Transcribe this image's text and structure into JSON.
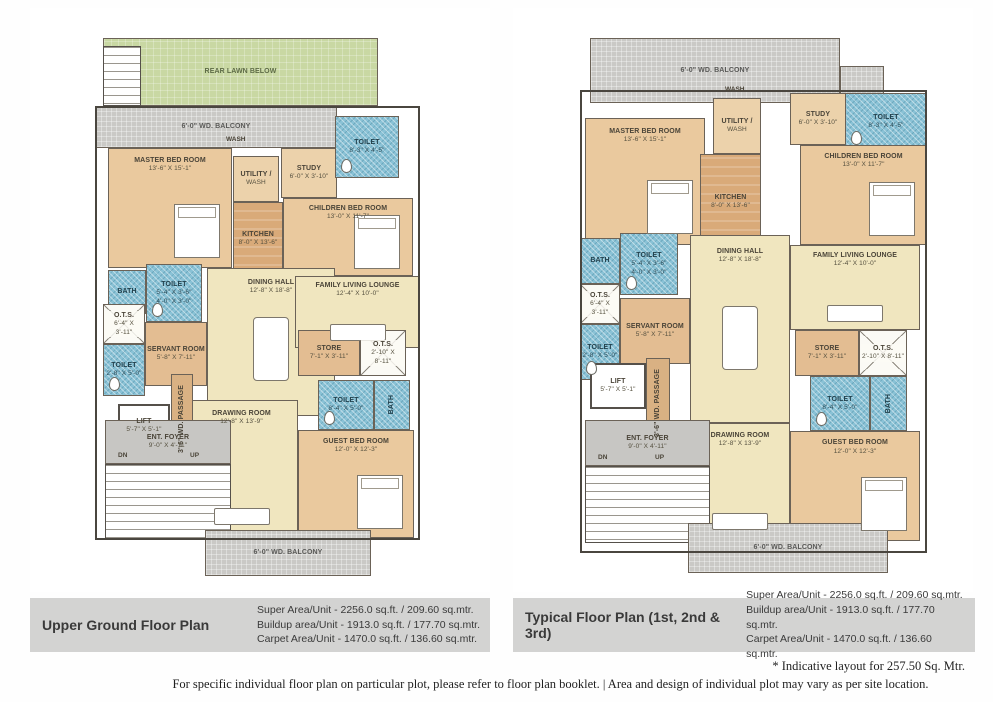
{
  "palette": {
    "lawn": "#c9d8a3",
    "balcony": "#cac9c6",
    "bedroom": "#eac99e",
    "kitchen": "#d9aa79",
    "living": "#f0e6bf",
    "toilet_mosaic": "#8ac2d6",
    "servant": "#e3bd92",
    "foyer": "#c7c6c3",
    "caption_bar": "#d3d3d2",
    "wall": "#4a463f"
  },
  "footer": {
    "note": "* Indicative layout for 257.50 Sq. Mtr.",
    "disclaimer": "For specific individual floor plan on particular plot, please refer to floor plan booklet.  |  Area and design of individual plot may vary as per site location."
  },
  "plans": [
    {
      "title": "Upper Ground Floor Plan",
      "areas": [
        "Super Area/Unit - 2256.0 sq.ft. / 209.60 sq.mtr.",
        "Buildup area/Unit - 1913.0 sq.ft. / 177.70 sq.mtr.",
        "Carpet Area/Unit - 1470.0 sq.ft. / 136.60 sq.mtr."
      ],
      "rooms": [
        {
          "name": "REAR LAWN BELOW",
          "type": "lawn",
          "rect": [
            73,
            30,
            275,
            68
          ]
        },
        {
          "name": "",
          "type": "stair",
          "rect": [
            73,
            38,
            38,
            60
          ]
        },
        {
          "name": "6'-0\" WD. BALCONY",
          "type": "balcony",
          "rect": [
            65,
            98,
            242,
            42
          ]
        },
        {
          "name": "MASTER BED ROOM",
          "dims": "13'-6\" X 15'-1\"",
          "type": "bedroom",
          "rect": [
            78,
            140,
            124,
            120
          ],
          "furniture": "bed"
        },
        {
          "name": "UTILITY /",
          "dims": "WASH",
          "type": "utility",
          "rect": [
            203,
            148,
            46,
            46
          ]
        },
        {
          "name": "KITCHEN",
          "dims": "8'-0\" X 13'-6\"",
          "type": "kitchen",
          "rect": [
            203,
            194,
            50,
            74
          ]
        },
        {
          "name": "STUDY",
          "dims": "6'-0\" X 3'-10\"",
          "type": "utility",
          "rect": [
            251,
            140,
            56,
            50
          ]
        },
        {
          "name": "CHILDREN BED ROOM",
          "dims": "13'-0\" X 11'-7\"",
          "type": "bedroom",
          "rect": [
            253,
            190,
            130,
            78
          ],
          "furniture": "bed"
        },
        {
          "name": "DINING HALL",
          "dims": "12'-8\" X 18'-8\"",
          "type": "living",
          "rect": [
            177,
            260,
            128,
            148
          ],
          "furniture": "table"
        },
        {
          "name": "FAMILY LIVING LOUNGE",
          "dims": "12'-4\" X 10'-0\"",
          "type": "living",
          "rect": [
            265,
            268,
            125,
            72
          ],
          "furniture": "sofa"
        },
        {
          "name": "DRAWING ROOM",
          "dims": "12'-8\" X 13'-9\"",
          "type": "living",
          "rect": [
            155,
            392,
            113,
            138
          ],
          "furniture": "sofa"
        },
        {
          "name": "GUEST BED ROOM",
          "dims": "12'-0\" X 12'-3\"",
          "type": "bedroom",
          "rect": [
            268,
            422,
            116,
            108
          ],
          "furniture": "bed"
        },
        {
          "name": "TOILET",
          "dims": "8'-3\" X 4'-5\"",
          "type": "toilet",
          "rect": [
            305,
            108,
            64,
            62
          ]
        },
        {
          "name": "BATH",
          "type": "toilet",
          "rect": [
            78,
            262,
            38,
            44
          ]
        },
        {
          "name": "TOILET",
          "dims": "5'-4\" X 3'-6\"",
          "dims2": "4'-0\" X 3'-0\"",
          "type": "toilet",
          "rect": [
            116,
            256,
            56,
            58
          ]
        },
        {
          "name": "O.T.S.",
          "dims": "6'-4\" X 3'-11\"",
          "type": "ots",
          "rect": [
            73,
            296,
            42,
            40
          ]
        },
        {
          "name": "TOILET",
          "dims": "2'-8\" X 5'-0\"",
          "type": "toilet",
          "rect": [
            73,
            336,
            42,
            52
          ]
        },
        {
          "name": "SERVANT ROOM",
          "dims": "5'-8\" X 7'-11\"",
          "type": "servant",
          "rect": [
            115,
            314,
            62,
            64
          ]
        },
        {
          "name": "STORE",
          "dims": "7'-1\" X 3'-11\"",
          "type": "servant",
          "rect": [
            268,
            322,
            62,
            46
          ]
        },
        {
          "name": "O.T.S.",
          "dims": "2'-10\" X 8'-11\"",
          "type": "ots",
          "rect": [
            330,
            322,
            46,
            46
          ]
        },
        {
          "name": "TOILET",
          "dims": "8'-4\" X 5'-0\"",
          "type": "toilet",
          "rect": [
            288,
            372,
            56,
            50
          ]
        },
        {
          "name": "BATH",
          "type": "toilet",
          "rect": [
            344,
            372,
            36,
            50
          ],
          "vertical": true
        },
        {
          "name": "LIFT",
          "dims": "5'-7\" X 5'-1\"",
          "type": "lift",
          "rect": [
            88,
            396,
            52,
            44
          ]
        },
        {
          "name": "3'-6\" WD. PASSAGE",
          "type": "passage",
          "rect": [
            141,
            366,
            22,
            90
          ],
          "vertical": true
        },
        {
          "name": "ENT. FOYER",
          "dims": "9'-0\" X 4'-11\"",
          "type": "foyer",
          "rect": [
            75,
            412,
            126,
            44
          ]
        },
        {
          "name": "",
          "type": "stair",
          "rect": [
            75,
            456,
            126,
            76
          ]
        },
        {
          "name": "6'-0\" WD. BALCONY",
          "type": "balcony",
          "rect": [
            175,
            522,
            166,
            46
          ]
        },
        {
          "name": "",
          "type": "outline",
          "rect": [
            65,
            98,
            325,
            434
          ]
        }
      ],
      "labels": [
        {
          "text": "WASH",
          "x": 196,
          "y": 128
        },
        {
          "text": "DN",
          "x": 88,
          "y": 444
        },
        {
          "text": "UP",
          "x": 160,
          "y": 444
        }
      ]
    },
    {
      "title": "Typical Floor Plan (1st, 2nd & 3rd)",
      "areas": [
        "Super Area/Unit - 2256.0 sq.ft. / 209.60 sq.mtr.",
        "Buildup area/Unit - 1913.0 sq.ft. / 177.70 sq.mtr.",
        "Carpet Area/Unit - 1470.0 sq.ft. / 136.60 sq.mtr."
      ],
      "rooms": [
        {
          "name": "6'-0\" WD. BALCONY",
          "type": "balcony",
          "rect": [
            77,
            30,
            250,
            65
          ]
        },
        {
          "name": "",
          "type": "balcony",
          "rect": [
            327,
            58,
            44,
            37
          ]
        },
        {
          "name": "TOILET",
          "dims": "8'-3\" X 4'-5\"",
          "type": "toilet",
          "rect": [
            332,
            85,
            82,
            57
          ]
        },
        {
          "name": "MASTER BED ROOM",
          "dims": "13'-6\" X 15'-1\"",
          "type": "bedroom",
          "rect": [
            72,
            110,
            120,
            127
          ],
          "furniture": "bed"
        },
        {
          "name": "UTILITY /",
          "dims": "WASH",
          "type": "utility",
          "rect": [
            200,
            90,
            48,
            56
          ]
        },
        {
          "name": "KITCHEN",
          "dims": "8'-0\" X 13'-6\"",
          "type": "kitchen",
          "rect": [
            187,
            146,
            61,
            96
          ]
        },
        {
          "name": "STUDY",
          "dims": "6'-0\" X 3'-10\"",
          "type": "utility",
          "rect": [
            277,
            85,
            56,
            52
          ]
        },
        {
          "name": "CHILDREN BED ROOM",
          "dims": "13'-0\" X 11'-7\"",
          "type": "bedroom",
          "rect": [
            287,
            137,
            127,
            100
          ],
          "furniture": "bed"
        },
        {
          "name": "DINING HALL",
          "dims": "12'-8\" X 18'-8\"",
          "type": "living",
          "rect": [
            177,
            227,
            100,
            188
          ],
          "furniture": "table"
        },
        {
          "name": "FAMILY LIVING LOUNGE",
          "dims": "12'-4\" X 10'-0\"",
          "type": "living",
          "rect": [
            277,
            237,
            130,
            85
          ],
          "furniture": "sofa"
        },
        {
          "name": "DRAWING ROOM",
          "dims": "12'-8\" X 13'-9\"",
          "type": "living",
          "rect": [
            177,
            415,
            100,
            118
          ],
          "furniture": "sofa"
        },
        {
          "name": "GUEST BED ROOM",
          "dims": "12'-0\" X 12'-3\"",
          "type": "bedroom",
          "rect": [
            277,
            423,
            130,
            110
          ],
          "furniture": "bed"
        },
        {
          "name": "BATH",
          "type": "toilet",
          "rect": [
            67,
            230,
            40,
            46
          ]
        },
        {
          "name": "TOILET",
          "dims": "5'-4\" X 3'-6\"",
          "dims2": "4'-0\" X 3'-0\"",
          "type": "toilet",
          "rect": [
            107,
            225,
            58,
            62
          ]
        },
        {
          "name": "O.T.S.",
          "dims": "6'-4\" X 3'-11\"",
          "type": "ots",
          "rect": [
            67,
            276,
            40,
            40
          ]
        },
        {
          "name": "TOILET",
          "dims": "2'-8\" X 5'-0\"",
          "type": "toilet",
          "rect": [
            67,
            316,
            40,
            56
          ]
        },
        {
          "name": "SERVANT ROOM",
          "dims": "5'-8\" X 7'-11\"",
          "type": "servant",
          "rect": [
            107,
            290,
            70,
            66
          ]
        },
        {
          "name": "STORE",
          "dims": "7'-1\" X 3'-11\"",
          "type": "servant",
          "rect": [
            282,
            322,
            64,
            46
          ]
        },
        {
          "name": "O.T.S.",
          "dims": "2'-10\" X 8'-11\"",
          "type": "ots",
          "rect": [
            346,
            322,
            48,
            46
          ]
        },
        {
          "name": "TOILET",
          "dims": "8'-4\" X 5'-0\"",
          "type": "toilet",
          "rect": [
            297,
            368,
            60,
            55
          ]
        },
        {
          "name": "BATH",
          "type": "toilet",
          "rect": [
            357,
            368,
            37,
            55
          ],
          "vertical": true
        },
        {
          "name": "LIFT",
          "dims": "5'-7\" X 5'-1\"",
          "type": "lift",
          "rect": [
            77,
            355,
            56,
            46
          ]
        },
        {
          "name": "3'-6\" WD. PASSAGE",
          "type": "passage",
          "rect": [
            133,
            350,
            24,
            90
          ],
          "vertical": true
        },
        {
          "name": "ENT. FOYER",
          "dims": "9'-0\" X 4'-11\"",
          "type": "foyer",
          "rect": [
            72,
            412,
            125,
            46
          ]
        },
        {
          "name": "",
          "type": "stair",
          "rect": [
            72,
            458,
            125,
            77
          ]
        },
        {
          "name": "6'-0\" WD. BALCONY",
          "type": "balcony",
          "rect": [
            175,
            515,
            200,
            50
          ]
        },
        {
          "name": "",
          "type": "outline",
          "rect": [
            67,
            82,
            347,
            463
          ]
        }
      ],
      "labels": [
        {
          "text": "WASH",
          "x": 212,
          "y": 78
        },
        {
          "text": "DN",
          "x": 85,
          "y": 446
        },
        {
          "text": "UP",
          "x": 142,
          "y": 446
        }
      ]
    }
  ]
}
